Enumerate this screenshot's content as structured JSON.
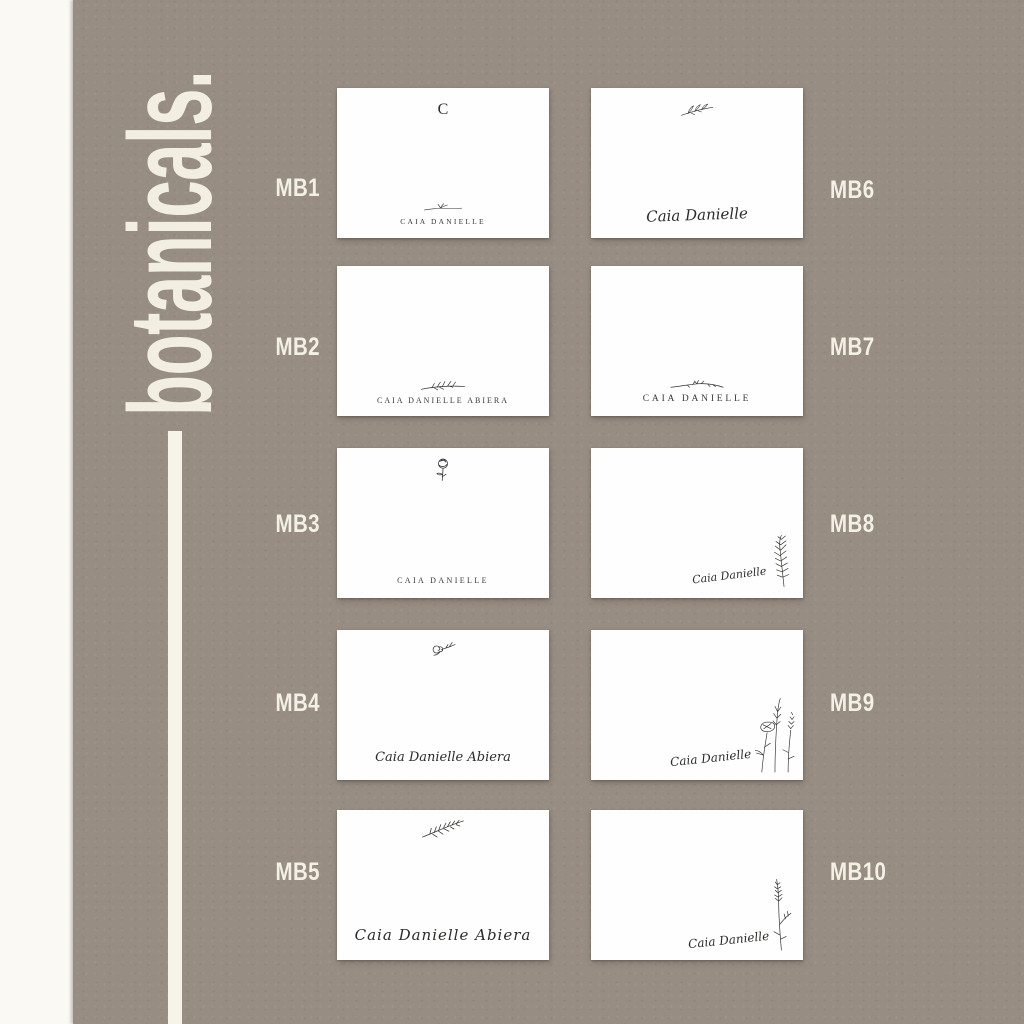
{
  "page": {
    "brand": "botanicals.",
    "colors": {
      "background_taupe": "#978d82",
      "cream_accent": "#f2eee1",
      "left_strip": "#fbf9f3",
      "card_white": "#fefefe",
      "ink": "#32302d"
    }
  },
  "cards": [
    {
      "code": "MB1",
      "monogram": "C",
      "name": "CAIA DANIELLE",
      "motif": "flourish-sprig"
    },
    {
      "code": "MB2",
      "name": "CAIA DANIELLE ABIERA",
      "motif": "twig-branch"
    },
    {
      "code": "MB3",
      "name": "CAIA DANIELLE",
      "motif": "peony-flower"
    },
    {
      "code": "MB4",
      "name": "Caia Danielle Abiera",
      "motif": "rose-sprig"
    },
    {
      "code": "MB5",
      "name": "Caia Danielle Abiera",
      "motif": "fern-leaf"
    },
    {
      "code": "MB6",
      "name": "Caia Danielle",
      "motif": "leafy-branch"
    },
    {
      "code": "MB7",
      "name": "CAIA DANIELLE",
      "motif": "botanical-flourish"
    },
    {
      "code": "MB8",
      "name": "Caia Danielle",
      "motif": "rosemary-sprig"
    },
    {
      "code": "MB9",
      "name": "Caia Danielle",
      "motif": "wildflowers"
    },
    {
      "code": "MB10",
      "name": "Caia Danielle",
      "motif": "lavender-sprig"
    }
  ]
}
